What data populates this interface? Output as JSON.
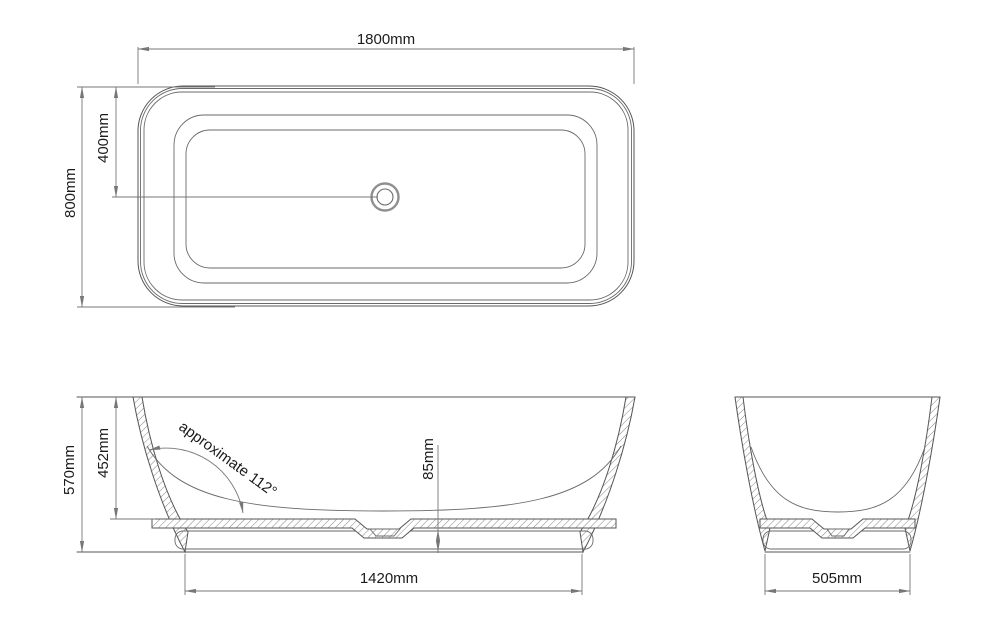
{
  "drawing": {
    "type": "bathtub-technical-drawing",
    "top_view": {
      "overall_length": "1800mm",
      "overall_width": "800mm",
      "drain_center_from_edge": "400mm"
    },
    "side_view": {
      "overall_height": "570mm",
      "inner_depth": "452mm",
      "wall_angle_note": "approximate 112°",
      "base_thickness": "85mm",
      "base_length": "1420mm"
    },
    "end_view": {
      "base_width": "505mm"
    },
    "colors": {
      "background": "#ffffff",
      "geometry_line": "#555555",
      "dimension_line": "#777777",
      "text": "#1b1b1b"
    }
  }
}
